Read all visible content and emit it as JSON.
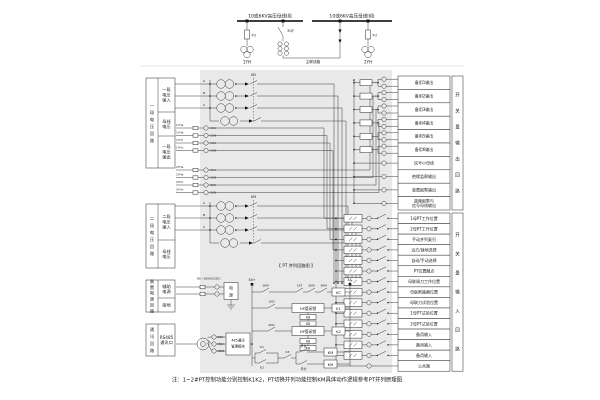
{
  "note": "注：1~2#PT控制功能分别控制K1K2，PT切换并列功能控制KM具体动作逻辑参考PT并列原理图",
  "top": {
    "bus1_label": "10或6KV高压母线I段",
    "bus2_label": "10或6KV高压母线II段",
    "fuse1": "FU",
    "fuse2": "FU",
    "pt1": "1YH",
    "pt2": "2YH",
    "breaker": "3QF",
    "tie_label": "主联线路"
  },
  "left_panels": {
    "p1": {
      "side": "一段电压回路",
      "r1": "一段电压输入",
      "r2": "母线电压",
      "r3": "一段电压输出"
    },
    "p2": {
      "side": "二段电压回路",
      "r1": "二段电压输入",
      "r2": "母线电压"
    },
    "p3": {
      "side": "装置电源回路",
      "r1": "辅助电源",
      "r2": "接地"
    },
    "p4": {
      "side": "通讯回路",
      "r1": "RS485通讯口"
    }
  },
  "pt_groups": {
    "g1_phases": [
      "A",
      "B",
      "C"
    ],
    "g2_phases": [
      "A",
      "B",
      "C"
    ],
    "g1_link_label": "KD",
    "g2_link_label": "KM",
    "g1_stubs": [
      "1YHa",
      "1YHb",
      "1YHc",
      "1YHn"
    ],
    "g1_terminals": [
      "1UA",
      "1UB",
      "1UC",
      "1UN"
    ],
    "g2_stubs": [
      "2YHa",
      "2YHb",
      "2YHc",
      "2YHn"
    ],
    "g2_terminals": [
      "2UA",
      "2UB",
      "2UC",
      "2UN"
    ]
  },
  "outputs": {
    "side_label": "开关量输出回路",
    "rows": [
      "备用1输出",
      "备用2输出",
      "备用3输出",
      "备用4输出",
      "备用5输出",
      "备用6输出",
      "信号小母线",
      "绝缘监察输出",
      "装置报警输出",
      "故障报警与信号母线输出"
    ]
  },
  "inputs": {
    "side_label": "开关量输入回路",
    "rows": [
      "1母PT工作位置",
      "2母PT工作位置",
      "手动并列复归",
      "远方/就地选择",
      "自动/手动选择",
      "PT位置触点",
      "母联闸刀工作位置",
      "母联断路器位置",
      "母联刀试验位置",
      "1母PT试验位置",
      "2母PT试验位置",
      "备用输入",
      "备用输入",
      "备用输入",
      "公共端"
    ]
  },
  "ladder": {
    "title": "【 PT 并列回路图 】",
    "rail_left": "5A+",
    "rail_right": "5A-",
    "r1c1": "1KM",
    "r1c2": "1KT",
    "r1c3": "2KM",
    "r1c4": "3KM",
    "r1_coil": "KC",
    "r2_contact": "1KD",
    "r2_box": "HP管闭锁",
    "r2_sub1": "KB",
    "r2_sub2": "KB",
    "r2_coil": "K1",
    "r3_contact": "2KD",
    "r3_box": "HP管闭锁",
    "r3_sub1": "KB",
    "r3_sub2": "KB",
    "r3_coil": "K2",
    "r4_k1": "K1",
    "r4_k2": "K2",
    "r4_k3": "K3",
    "r4_on": "手合",
    "r4_off": "手分",
    "r4_coil1": "KM",
    "r4_coil2": "KM"
  },
  "power": {
    "range": "85~265VAC/DC",
    "box": "电源",
    "comm_line1": "485通讯",
    "comm_line2": "管理模块",
    "t1": "GND",
    "t2": "485A",
    "t3": "485B"
  }
}
